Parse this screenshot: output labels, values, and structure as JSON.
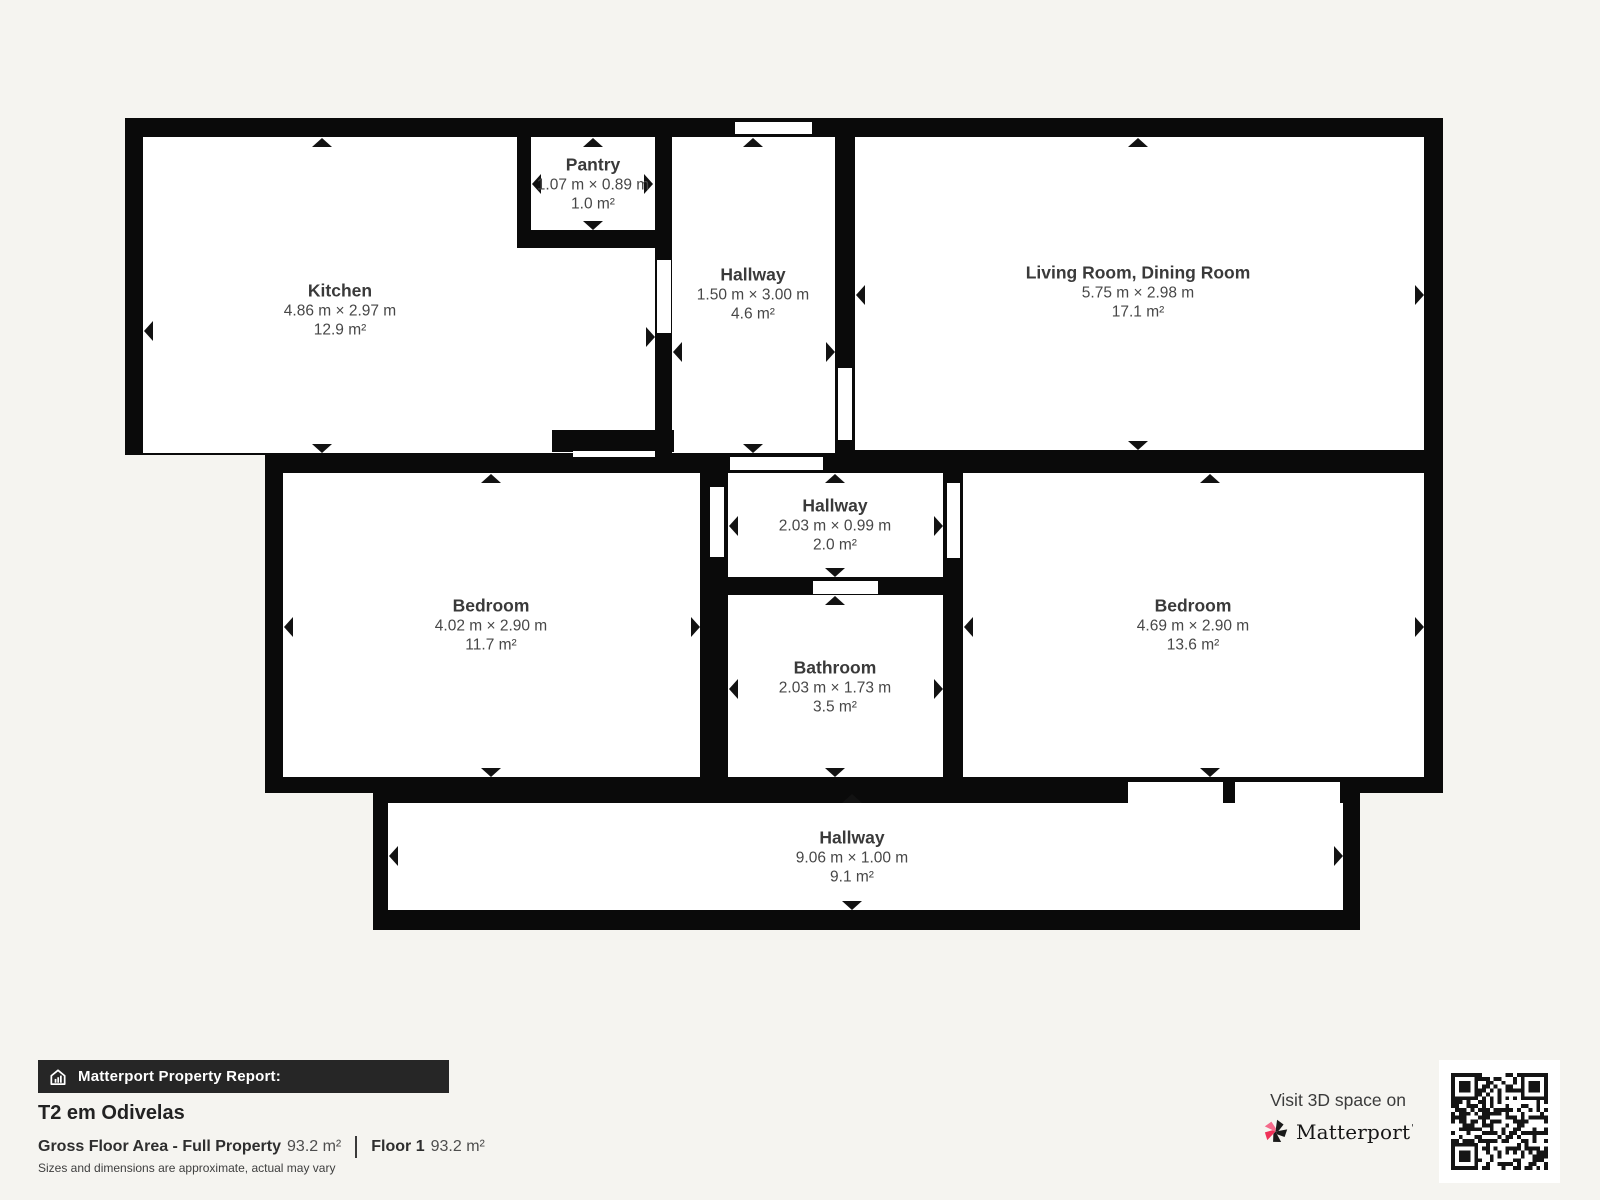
{
  "colors": {
    "background": "#f5f4f0",
    "wall": "#0a0a0a",
    "room": "#ffffff",
    "label_text": "#3e3e3e",
    "footer_bar": "#262626",
    "brand_red": "#ef3158",
    "brand_pink": "#f4698a"
  },
  "rooms": [
    {
      "id": "kitchen",
      "name": "Kitchen",
      "dims": "4.86 m × 2.97 m",
      "area": "12.9 m²"
    },
    {
      "id": "pantry",
      "name": "Pantry",
      "dims": "1.07 m × 0.89 m",
      "area": "1.0 m²"
    },
    {
      "id": "hallway-top",
      "name": "Hallway",
      "dims": "1.50 m × 3.00 m",
      "area": "4.6 m²"
    },
    {
      "id": "living-room",
      "name": "Living Room, Dining Room",
      "dims": "5.75 m × 2.98 m",
      "area": "17.1 m²"
    },
    {
      "id": "bedroom-left",
      "name": "Bedroom",
      "dims": "4.02 m × 2.90 m",
      "area": "11.7 m²"
    },
    {
      "id": "hallway-mid",
      "name": "Hallway",
      "dims": "2.03 m × 0.99 m",
      "area": "2.0 m²"
    },
    {
      "id": "bathroom",
      "name": "Bathroom",
      "dims": "2.03 m × 1.73 m",
      "area": "3.5 m²"
    },
    {
      "id": "bedroom-right",
      "name": "Bedroom",
      "dims": "4.69 m × 2.90 m",
      "area": "13.6 m²"
    },
    {
      "id": "hallway-bottom",
      "name": "Hallway",
      "dims": "9.06 m × 1.00 m",
      "area": "9.1 m²"
    }
  ],
  "footer": {
    "report_label": "Matterport Property Report:",
    "property_title": "T2 em Odivelas",
    "gross_label": "Gross Floor Area - Full Property",
    "gross_value": "93.2 m²",
    "floor_label": "Floor 1",
    "floor_value": "93.2 m²",
    "disclaimer": "Sizes and dimensions are approximate, actual may vary",
    "visit_text": "Visit 3D space on",
    "brand": "Matterport",
    "brand_mark": "'"
  }
}
